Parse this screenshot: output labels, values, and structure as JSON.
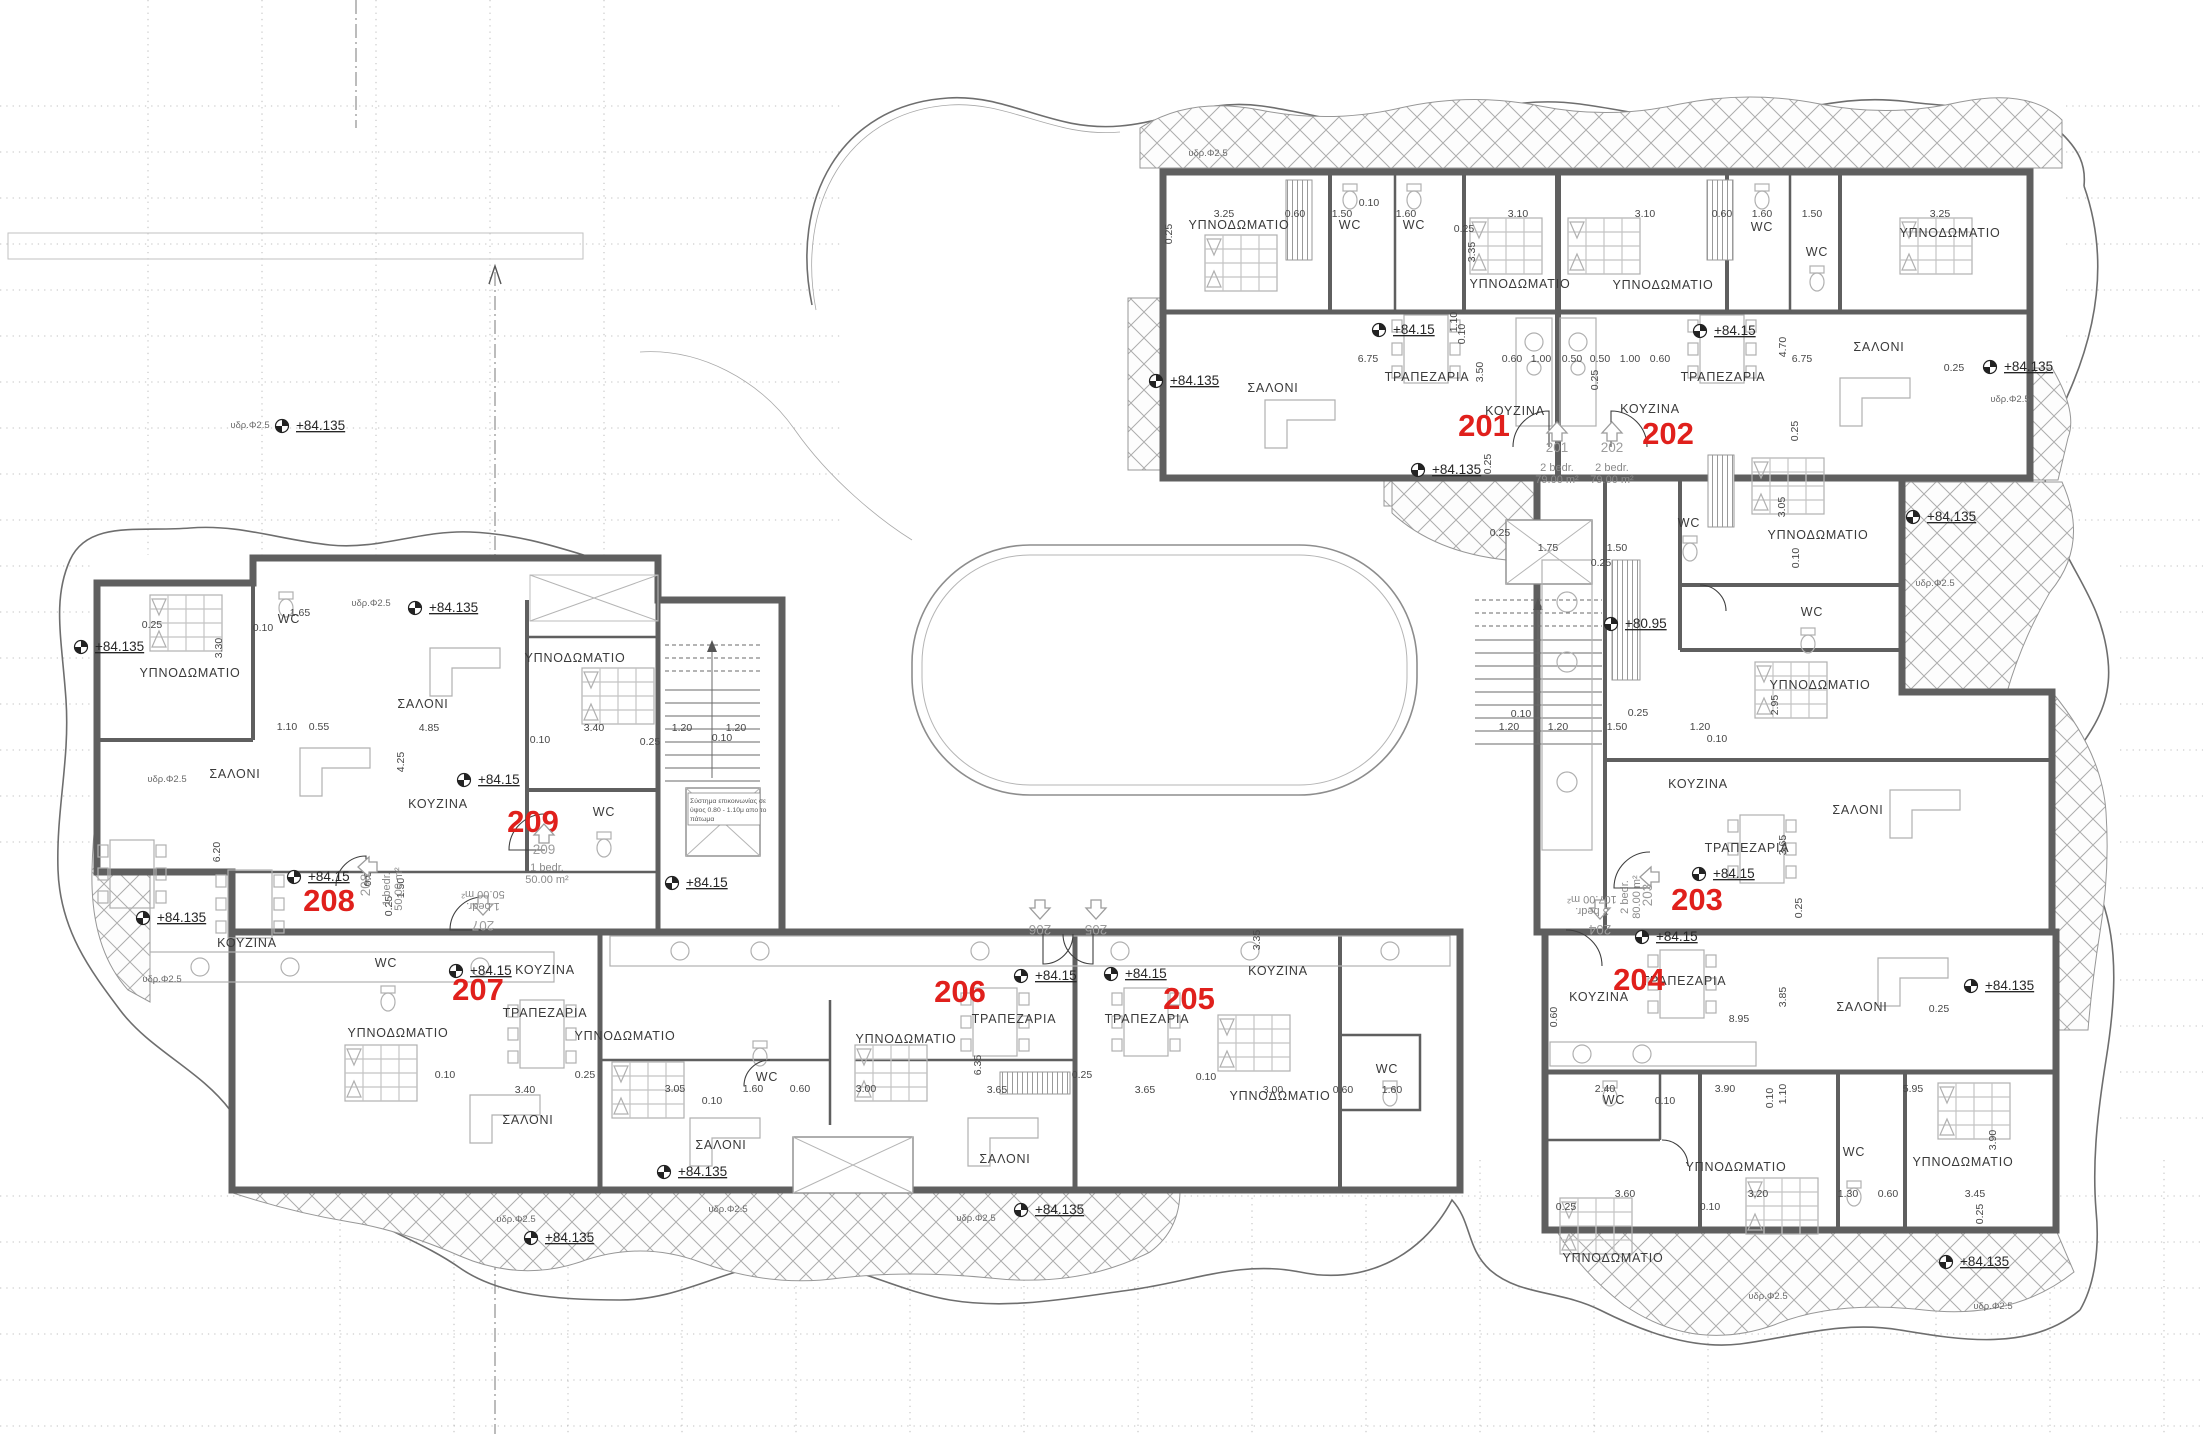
{
  "drawing": {
    "kind": "apartment floor plan",
    "floor_elevation_main": "+84.15",
    "floor_elevation_balcony": "+84.135",
    "floor_elevation_stair_landing": "+80.95"
  },
  "colors": {
    "unit_label_red": "#e0201c",
    "wall_gray": "#5f5f5f",
    "hatch_gray": "#adadad",
    "text_dark": "#3a3a3a",
    "benchmark_black": "#222222"
  },
  "units": [
    {
      "number": "201",
      "type": "2 bedr.",
      "area": "79.00 m²"
    },
    {
      "number": "202",
      "type": "2 bedr.",
      "area": "79.00 m²"
    },
    {
      "number": "203",
      "type": "2 bedr.",
      "area": "80.00 m²"
    },
    {
      "number": "204",
      "type": "3 bedr.",
      "area": "107.00 m²"
    },
    {
      "number": "205",
      "type": "",
      "area": ""
    },
    {
      "number": "206",
      "type": "",
      "area": ""
    },
    {
      "number": "207",
      "type": "1 bedr.",
      "area": "50.00 m²"
    },
    {
      "number": "208",
      "type": "1 bedr.",
      "area": "50.00 m²"
    },
    {
      "number": "209",
      "type": "1 bedr.",
      "area": "50.00 m²"
    }
  ],
  "labels": {
    "unit_numbers": [
      {
        "t": "201",
        "x": 1484,
        "y": 436
      },
      {
        "t": "202",
        "x": 1668,
        "y": 444
      },
      {
        "t": "203",
        "x": 1697,
        "y": 910
      },
      {
        "t": "204",
        "x": 1639,
        "y": 990
      },
      {
        "t": "205",
        "x": 1189,
        "y": 1009
      },
      {
        "t": "206",
        "x": 960,
        "y": 1002
      },
      {
        "t": "207",
        "x": 478,
        "y": 1000
      },
      {
        "t": "208",
        "x": 329,
        "y": 911
      },
      {
        "t": "209",
        "x": 533,
        "y": 832
      }
    ],
    "door_tags": [
      {
        "t": "201",
        "x": 1557,
        "y": 452,
        "r": 0
      },
      {
        "t": "202",
        "x": 1612,
        "y": 452,
        "r": 0
      },
      {
        "t": "203",
        "x": 1652,
        "y": 895,
        "r": -90
      },
      {
        "t": "204",
        "x": 1600,
        "y": 925,
        "r": 180
      },
      {
        "t": "205",
        "x": 1096,
        "y": 925,
        "r": 180
      },
      {
        "t": "206",
        "x": 1040,
        "y": 925,
        "r": 180
      },
      {
        "t": "207",
        "x": 483,
        "y": 921,
        "r": 180
      },
      {
        "t": "208",
        "x": 370,
        "y": 885,
        "r": -90
      },
      {
        "t": "209",
        "x": 544,
        "y": 854,
        "r": 0
      }
    ],
    "unit_info": [
      {
        "lines": [
          "2 bedr.",
          "79.00 m²"
        ],
        "x": 1557,
        "y": 471,
        "r": 0
      },
      {
        "lines": [
          "2 bedr.",
          "79.00 m²"
        ],
        "x": 1612,
        "y": 471,
        "r": 0
      },
      {
        "lines": [
          "2 bedr.",
          "80.00 m²"
        ],
        "x": 1628,
        "y": 897,
        "r": -90
      },
      {
        "lines": [
          "3 bedr.",
          "107.00 m²"
        ],
        "x": 1592,
        "y": 908,
        "r": 180
      },
      {
        "lines": [
          "1 bedr.",
          "50.00 m²"
        ],
        "x": 483,
        "y": 903,
        "r": 180
      },
      {
        "lines": [
          "1 bedr.",
          "50.00 m²"
        ],
        "x": 390,
        "y": 889,
        "r": -90
      },
      {
        "lines": [
          "1 bedr.",
          "50.00 m²"
        ],
        "x": 547,
        "y": 871,
        "r": 0
      }
    ],
    "rooms": [
      {
        "t": "ΥΠΝΟΔΩΜΑΤΙΟ",
        "x": 1239,
        "y": 229
      },
      {
        "t": "ΥΠΝΟΔΩΜΑΤΙΟ",
        "x": 1520,
        "y": 288
      },
      {
        "t": "ΥΠΝΟΔΩΜΑΤΙΟ",
        "x": 1663,
        "y": 289
      },
      {
        "t": "ΥΠΝΟΔΩΜΑΤΙΟ",
        "x": 1950,
        "y": 237
      },
      {
        "t": "ΥΠΝΟΔΩΜΑΤΙΟ",
        "x": 1818,
        "y": 539
      },
      {
        "t": "ΥΠΝΟΔΩΜΑΤΙΟ",
        "x": 1820,
        "y": 689
      },
      {
        "t": "ΥΠΝΟΔΩΜΑΤΙΟ",
        "x": 1280,
        "y": 1100
      },
      {
        "t": "ΥΠΝΟΔΩΜΑΤΙΟ",
        "x": 398,
        "y": 1037
      },
      {
        "t": "ΥΠΝΟΔΩΜΑΤΙΟ",
        "x": 625,
        "y": 1040
      },
      {
        "t": "ΥΠΝΟΔΩΜΑΤΙΟ",
        "x": 906,
        "y": 1043
      },
      {
        "t": "ΥΠΝΟΔΩΜΑΤΙΟ",
        "x": 1613,
        "y": 1262
      },
      {
        "t": "ΥΠΝΟΔΩΜΑΤΙΟ",
        "x": 1736,
        "y": 1171
      },
      {
        "t": "ΥΠΝΟΔΩΜΑΤΙΟ",
        "x": 1963,
        "y": 1166
      },
      {
        "t": "ΥΠΝΟΔΩΜΑΤΙΟ",
        "x": 575,
        "y": 662
      },
      {
        "t": "ΥΠΝΟΔΩΜΑΤΙΟ",
        "x": 190,
        "y": 677
      },
      {
        "t": "ΣΑΛΟΝΙ",
        "x": 1273,
        "y": 392
      },
      {
        "t": "ΣΑΛΟΝΙ",
        "x": 1879,
        "y": 351
      },
      {
        "t": "ΣΑΛΟΝΙ",
        "x": 1858,
        "y": 814
      },
      {
        "t": "ΣΑΛΟΝΙ",
        "x": 1862,
        "y": 1011
      },
      {
        "t": "ΣΑΛΟΝΙ",
        "x": 1005,
        "y": 1163
      },
      {
        "t": "ΣΑΛΟΝΙ",
        "x": 721,
        "y": 1149
      },
      {
        "t": "ΣΑΛΟΝΙ",
        "x": 528,
        "y": 1124
      },
      {
        "t": "ΣΑΛΟΝΙ",
        "x": 235,
        "y": 778
      },
      {
        "t": "ΣΑΛΟΝΙ",
        "x": 423,
        "y": 708
      },
      {
        "t": "ΚΟΥΖΙΝΑ",
        "x": 1515,
        "y": 415
      },
      {
        "t": "ΚΟΥΖΙΝΑ",
        "x": 1650,
        "y": 413
      },
      {
        "t": "ΚΟΥΖΙΝΑ",
        "x": 1698,
        "y": 788
      },
      {
        "t": "ΚΟΥΖΙΝΑ",
        "x": 1599,
        "y": 1001
      },
      {
        "t": "ΚΟΥΖΙΝΑ",
        "x": 1278,
        "y": 975
      },
      {
        "t": "ΚΟΥΖΙΝΑ",
        "x": 545,
        "y": 974
      },
      {
        "t": "ΚΟΥΖΙΝΑ",
        "x": 438,
        "y": 808
      },
      {
        "t": "ΚΟΥΖΙΝΑ",
        "x": 247,
        "y": 947
      },
      {
        "t": "ΤΡΑΠΕΖΑΡΙΑ",
        "x": 1427,
        "y": 381
      },
      {
        "t": "ΤΡΑΠΕΖΑΡΙΑ",
        "x": 1723,
        "y": 381
      },
      {
        "t": "ΤΡΑΠΕΖΑΡΙΑ",
        "x": 1747,
        "y": 852
      },
      {
        "t": "ΤΡΑΠΕΖΑΡΙΑ",
        "x": 1684,
        "y": 985
      },
      {
        "t": "ΤΡΑΠΕΖΑΡΙΑ",
        "x": 1147,
        "y": 1023
      },
      {
        "t": "ΤΡΑΠΕΖΑΡΙΑ",
        "x": 1014,
        "y": 1023
      },
      {
        "t": "ΤΡΑΠΕΖΑΡΙΑ",
        "x": 545,
        "y": 1017
      },
      {
        "t": "WC",
        "x": 1350,
        "y": 229
      },
      {
        "t": "WC",
        "x": 1414,
        "y": 229
      },
      {
        "t": "WC",
        "x": 1762,
        "y": 231
      },
      {
        "t": "WC",
        "x": 1817,
        "y": 256
      },
      {
        "t": "WC",
        "x": 1689,
        "y": 527
      },
      {
        "t": "WC",
        "x": 1812,
        "y": 616
      },
      {
        "t": "WC",
        "x": 1614,
        "y": 1104
      },
      {
        "t": "WC",
        "x": 1854,
        "y": 1156
      },
      {
        "t": "WC",
        "x": 767,
        "y": 1081
      },
      {
        "t": "WC",
        "x": 1387,
        "y": 1073
      },
      {
        "t": "WC",
        "x": 604,
        "y": 816
      },
      {
        "t": "WC",
        "x": 386,
        "y": 967
      },
      {
        "t": "WC",
        "x": 289,
        "y": 623
      }
    ],
    "elevations": [
      {
        "t": "+84.15",
        "x": 1393,
        "y": 334
      },
      {
        "t": "+84.15",
        "x": 1714,
        "y": 335
      },
      {
        "t": "+84.15",
        "x": 1713,
        "y": 878
      },
      {
        "t": "+84.15",
        "x": 1656,
        "y": 941
      },
      {
        "t": "+84.15",
        "x": 1125,
        "y": 978
      },
      {
        "t": "+84.15",
        "x": 1035,
        "y": 980
      },
      {
        "t": "+84.15",
        "x": 470,
        "y": 975
      },
      {
        "t": "+84.15",
        "x": 308,
        "y": 881
      },
      {
        "t": "+84.15",
        "x": 478,
        "y": 784
      },
      {
        "t": "+84.15",
        "x": 686,
        "y": 887
      },
      {
        "t": "+84.135",
        "x": 2004,
        "y": 371
      },
      {
        "t": "+84.135",
        "x": 1432,
        "y": 474
      },
      {
        "t": "+84.135",
        "x": 1170,
        "y": 385
      },
      {
        "t": "+84.135",
        "x": 1927,
        "y": 521
      },
      {
        "t": "+84.135",
        "x": 1985,
        "y": 990
      },
      {
        "t": "+84.135",
        "x": 1960,
        "y": 1266
      },
      {
        "t": "+84.135",
        "x": 678,
        "y": 1176
      },
      {
        "t": "+84.135",
        "x": 1035,
        "y": 1214
      },
      {
        "t": "+84.135",
        "x": 545,
        "y": 1242
      },
      {
        "t": "+84.135",
        "x": 157,
        "y": 922
      },
      {
        "t": "+84.135",
        "x": 429,
        "y": 612
      },
      {
        "t": "+84.135",
        "x": 95,
        "y": 651
      },
      {
        "t": "+84.135",
        "x": 296,
        "y": 430
      },
      {
        "t": "+80.95",
        "x": 1625,
        "y": 628
      }
    ],
    "pipe_notes": [
      {
        "t": "υδρ.Φ2.5",
        "x": 1208,
        "y": 156
      },
      {
        "t": "υδρ.Φ2.5",
        "x": 2010,
        "y": 402
      },
      {
        "t": "υδρ.Φ2.5",
        "x": 1935,
        "y": 586
      },
      {
        "t": "υδρ.Φ2.5",
        "x": 371,
        "y": 606
      },
      {
        "t": "υδρ.Φ2.5",
        "x": 167,
        "y": 782
      },
      {
        "t": "υδρ.Φ2.5",
        "x": 162,
        "y": 982
      },
      {
        "t": "υδρ.Φ2.5",
        "x": 728,
        "y": 1212
      },
      {
        "t": "υδρ.Φ2.5",
        "x": 976,
        "y": 1221
      },
      {
        "t": "υδρ.Φ2.5",
        "x": 516,
        "y": 1222
      },
      {
        "t": "υδρ.Φ2.5",
        "x": 1768,
        "y": 1299
      },
      {
        "t": "υδρ.Φ2.5",
        "x": 1993,
        "y": 1309
      },
      {
        "t": "υδρ.Φ2.5",
        "x": 250,
        "y": 428
      }
    ],
    "note_box": {
      "x": 690,
      "y": 803,
      "lines": [
        "Σύστημα επικοινωνίας σε",
        "ύψος 0.80 - 1.10μ απο το",
        "πάτωμα"
      ]
    },
    "dimensions": [
      {
        "t": "3.25",
        "x": 1224,
        "y": 217
      },
      {
        "t": "0.60",
        "x": 1295,
        "y": 217
      },
      {
        "t": "1.50",
        "x": 1342,
        "y": 217
      },
      {
        "t": "1.60",
        "x": 1406,
        "y": 217
      },
      {
        "t": "0.10",
        "x": 1369,
        "y": 206
      },
      {
        "t": "3.10",
        "x": 1518,
        "y": 217
      },
      {
        "t": "3.10",
        "x": 1645,
        "y": 217
      },
      {
        "t": "0.60",
        "x": 1722,
        "y": 217
      },
      {
        "t": "1.60",
        "x": 1762,
        "y": 217
      },
      {
        "t": "1.50",
        "x": 1812,
        "y": 217
      },
      {
        "t": "3.25",
        "x": 1940,
        "y": 217
      },
      {
        "t": "0.25",
        "x": 1172,
        "y": 234,
        "r": 1
      },
      {
        "t": "0.25",
        "x": 1464,
        "y": 232
      },
      {
        "t": "3.35",
        "x": 1475,
        "y": 252,
        "r": 1
      },
      {
        "t": "1.10",
        "x": 1457,
        "y": 322,
        "r": 1
      },
      {
        "t": "6.75",
        "x": 1368,
        "y": 362
      },
      {
        "t": "3.50",
        "x": 1483,
        "y": 372,
        "r": 1
      },
      {
        "t": "0.10",
        "x": 1465,
        "y": 334,
        "r": 1
      },
      {
        "t": "0.60",
        "x": 1512,
        "y": 362
      },
      {
        "t": "1.00",
        "x": 1541,
        "y": 362
      },
      {
        "t": "0.50",
        "x": 1572,
        "y": 362
      },
      {
        "t": "0.50",
        "x": 1600,
        "y": 362
      },
      {
        "t": "1.00",
        "x": 1630,
        "y": 362
      },
      {
        "t": "0.60",
        "x": 1660,
        "y": 362
      },
      {
        "t": "0.25",
        "x": 1598,
        "y": 380,
        "r": 1
      },
      {
        "t": "6.75",
        "x": 1802,
        "y": 362
      },
      {
        "t": "4.70",
        "x": 1786,
        "y": 347,
        "r": 1
      },
      {
        "t": "0.25",
        "x": 1954,
        "y": 371
      },
      {
        "t": "0.25",
        "x": 1798,
        "y": 431,
        "r": 1
      },
      {
        "t": "0.25",
        "x": 1491,
        "y": 464,
        "r": 1
      },
      {
        "t": "0.25",
        "x": 1500,
        "y": 536
      },
      {
        "t": "1.75",
        "x": 1548,
        "y": 551
      },
      {
        "t": "1.50",
        "x": 1617,
        "y": 551
      },
      {
        "t": "0.25",
        "x": 1601,
        "y": 566
      },
      {
        "t": "3.05",
        "x": 1785,
        "y": 507,
        "r": 1
      },
      {
        "t": "0.10",
        "x": 1799,
        "y": 558,
        "r": 1
      },
      {
        "t": "1.20",
        "x": 1509,
        "y": 730
      },
      {
        "t": "1.20",
        "x": 1558,
        "y": 730
      },
      {
        "t": "0.10",
        "x": 1521,
        "y": 717
      },
      {
        "t": "1.50",
        "x": 1617,
        "y": 730
      },
      {
        "t": "1.20",
        "x": 1700,
        "y": 730
      },
      {
        "t": "0.10",
        "x": 1717,
        "y": 742
      },
      {
        "t": "0.25",
        "x": 1638,
        "y": 716
      },
      {
        "t": "2.95",
        "x": 1778,
        "y": 705,
        "r": 1
      },
      {
        "t": "3.65",
        "x": 1786,
        "y": 845,
        "r": 1
      },
      {
        "t": "0.25",
        "x": 1802,
        "y": 908,
        "r": 1
      },
      {
        "t": "3.85",
        "x": 1786,
        "y": 997,
        "r": 1
      },
      {
        "t": "8.95",
        "x": 1739,
        "y": 1022
      },
      {
        "t": "0.60",
        "x": 1557,
        "y": 1017,
        "r": 1
      },
      {
        "t": "0.25",
        "x": 1939,
        "y": 1012
      },
      {
        "t": "2.40",
        "x": 1605,
        "y": 1092
      },
      {
        "t": "3.90",
        "x": 1725,
        "y": 1092
      },
      {
        "t": "0.10",
        "x": 1665,
        "y": 1104
      },
      {
        "t": "1.10",
        "x": 1786,
        "y": 1094,
        "r": 1
      },
      {
        "t": "0.10",
        "x": 1773,
        "y": 1098,
        "r": 1
      },
      {
        "t": "5.95",
        "x": 1913,
        "y": 1092
      },
      {
        "t": "3.60",
        "x": 1625,
        "y": 1197
      },
      {
        "t": "0.10",
        "x": 1710,
        "y": 1210
      },
      {
        "t": "3.20",
        "x": 1758,
        "y": 1197
      },
      {
        "t": "1.30",
        "x": 1848,
        "y": 1197
      },
      {
        "t": "0.60",
        "x": 1888,
        "y": 1197
      },
      {
        "t": "3.45",
        "x": 1975,
        "y": 1197
      },
      {
        "t": "0.25",
        "x": 1983,
        "y": 1214,
        "r": 1
      },
      {
        "t": "3.90",
        "x": 1996,
        "y": 1140,
        "r": 1
      },
      {
        "t": "0.25",
        "x": 1566,
        "y": 1210
      },
      {
        "t": "6.35",
        "x": 981,
        "y": 1065,
        "r": 1
      },
      {
        "t": "3.65",
        "x": 997,
        "y": 1093
      },
      {
        "t": "3.65",
        "x": 1145,
        "y": 1093
      },
      {
        "t": "0.25",
        "x": 1082,
        "y": 1078
      },
      {
        "t": "0.10",
        "x": 1206,
        "y": 1080
      },
      {
        "t": "3.00",
        "x": 1273,
        "y": 1093
      },
      {
        "t": "0.60",
        "x": 1343,
        "y": 1093
      },
      {
        "t": "1.60",
        "x": 1392,
        "y": 1093
      },
      {
        "t": "3.35",
        "x": 1260,
        "y": 940,
        "r": 1
      },
      {
        "t": "3.40",
        "x": 525,
        "y": 1093
      },
      {
        "t": "0.10",
        "x": 445,
        "y": 1078
      },
      {
        "t": "0.25",
        "x": 585,
        "y": 1078
      },
      {
        "t": "3.05",
        "x": 675,
        "y": 1092
      },
      {
        "t": "1.60",
        "x": 753,
        "y": 1092
      },
      {
        "t": "0.60",
        "x": 800,
        "y": 1092
      },
      {
        "t": "3.00",
        "x": 866,
        "y": 1092
      },
      {
        "t": "0.10",
        "x": 712,
        "y": 1104
      },
      {
        "t": "0.25",
        "x": 152,
        "y": 628
      },
      {
        "t": "0.10",
        "x": 263,
        "y": 631
      },
      {
        "t": "1.65",
        "x": 300,
        "y": 616
      },
      {
        "t": "3.30",
        "x": 222,
        "y": 648,
        "r": 1
      },
      {
        "t": "1.10",
        "x": 287,
        "y": 730
      },
      {
        "t": "0.55",
        "x": 319,
        "y": 730
      },
      {
        "t": "4.85",
        "x": 429,
        "y": 731
      },
      {
        "t": "4.25",
        "x": 404,
        "y": 762,
        "r": 1
      },
      {
        "t": "6.20",
        "x": 220,
        "y": 852,
        "r": 1
      },
      {
        "t": "3.40",
        "x": 594,
        "y": 731
      },
      {
        "t": "1.20",
        "x": 682,
        "y": 731
      },
      {
        "t": "1.20",
        "x": 736,
        "y": 731
      },
      {
        "t": "0.10",
        "x": 722,
        "y": 741
      },
      {
        "t": "0.25",
        "x": 650,
        "y": 745
      },
      {
        "t": "0.10",
        "x": 540,
        "y": 743
      },
      {
        "t": "0.60",
        "x": 371,
        "y": 876,
        "r": 1
      },
      {
        "t": "1.50",
        "x": 404,
        "y": 888,
        "r": 1
      },
      {
        "t": "0.25",
        "x": 392,
        "y": 906,
        "r": 1
      }
    ]
  }
}
